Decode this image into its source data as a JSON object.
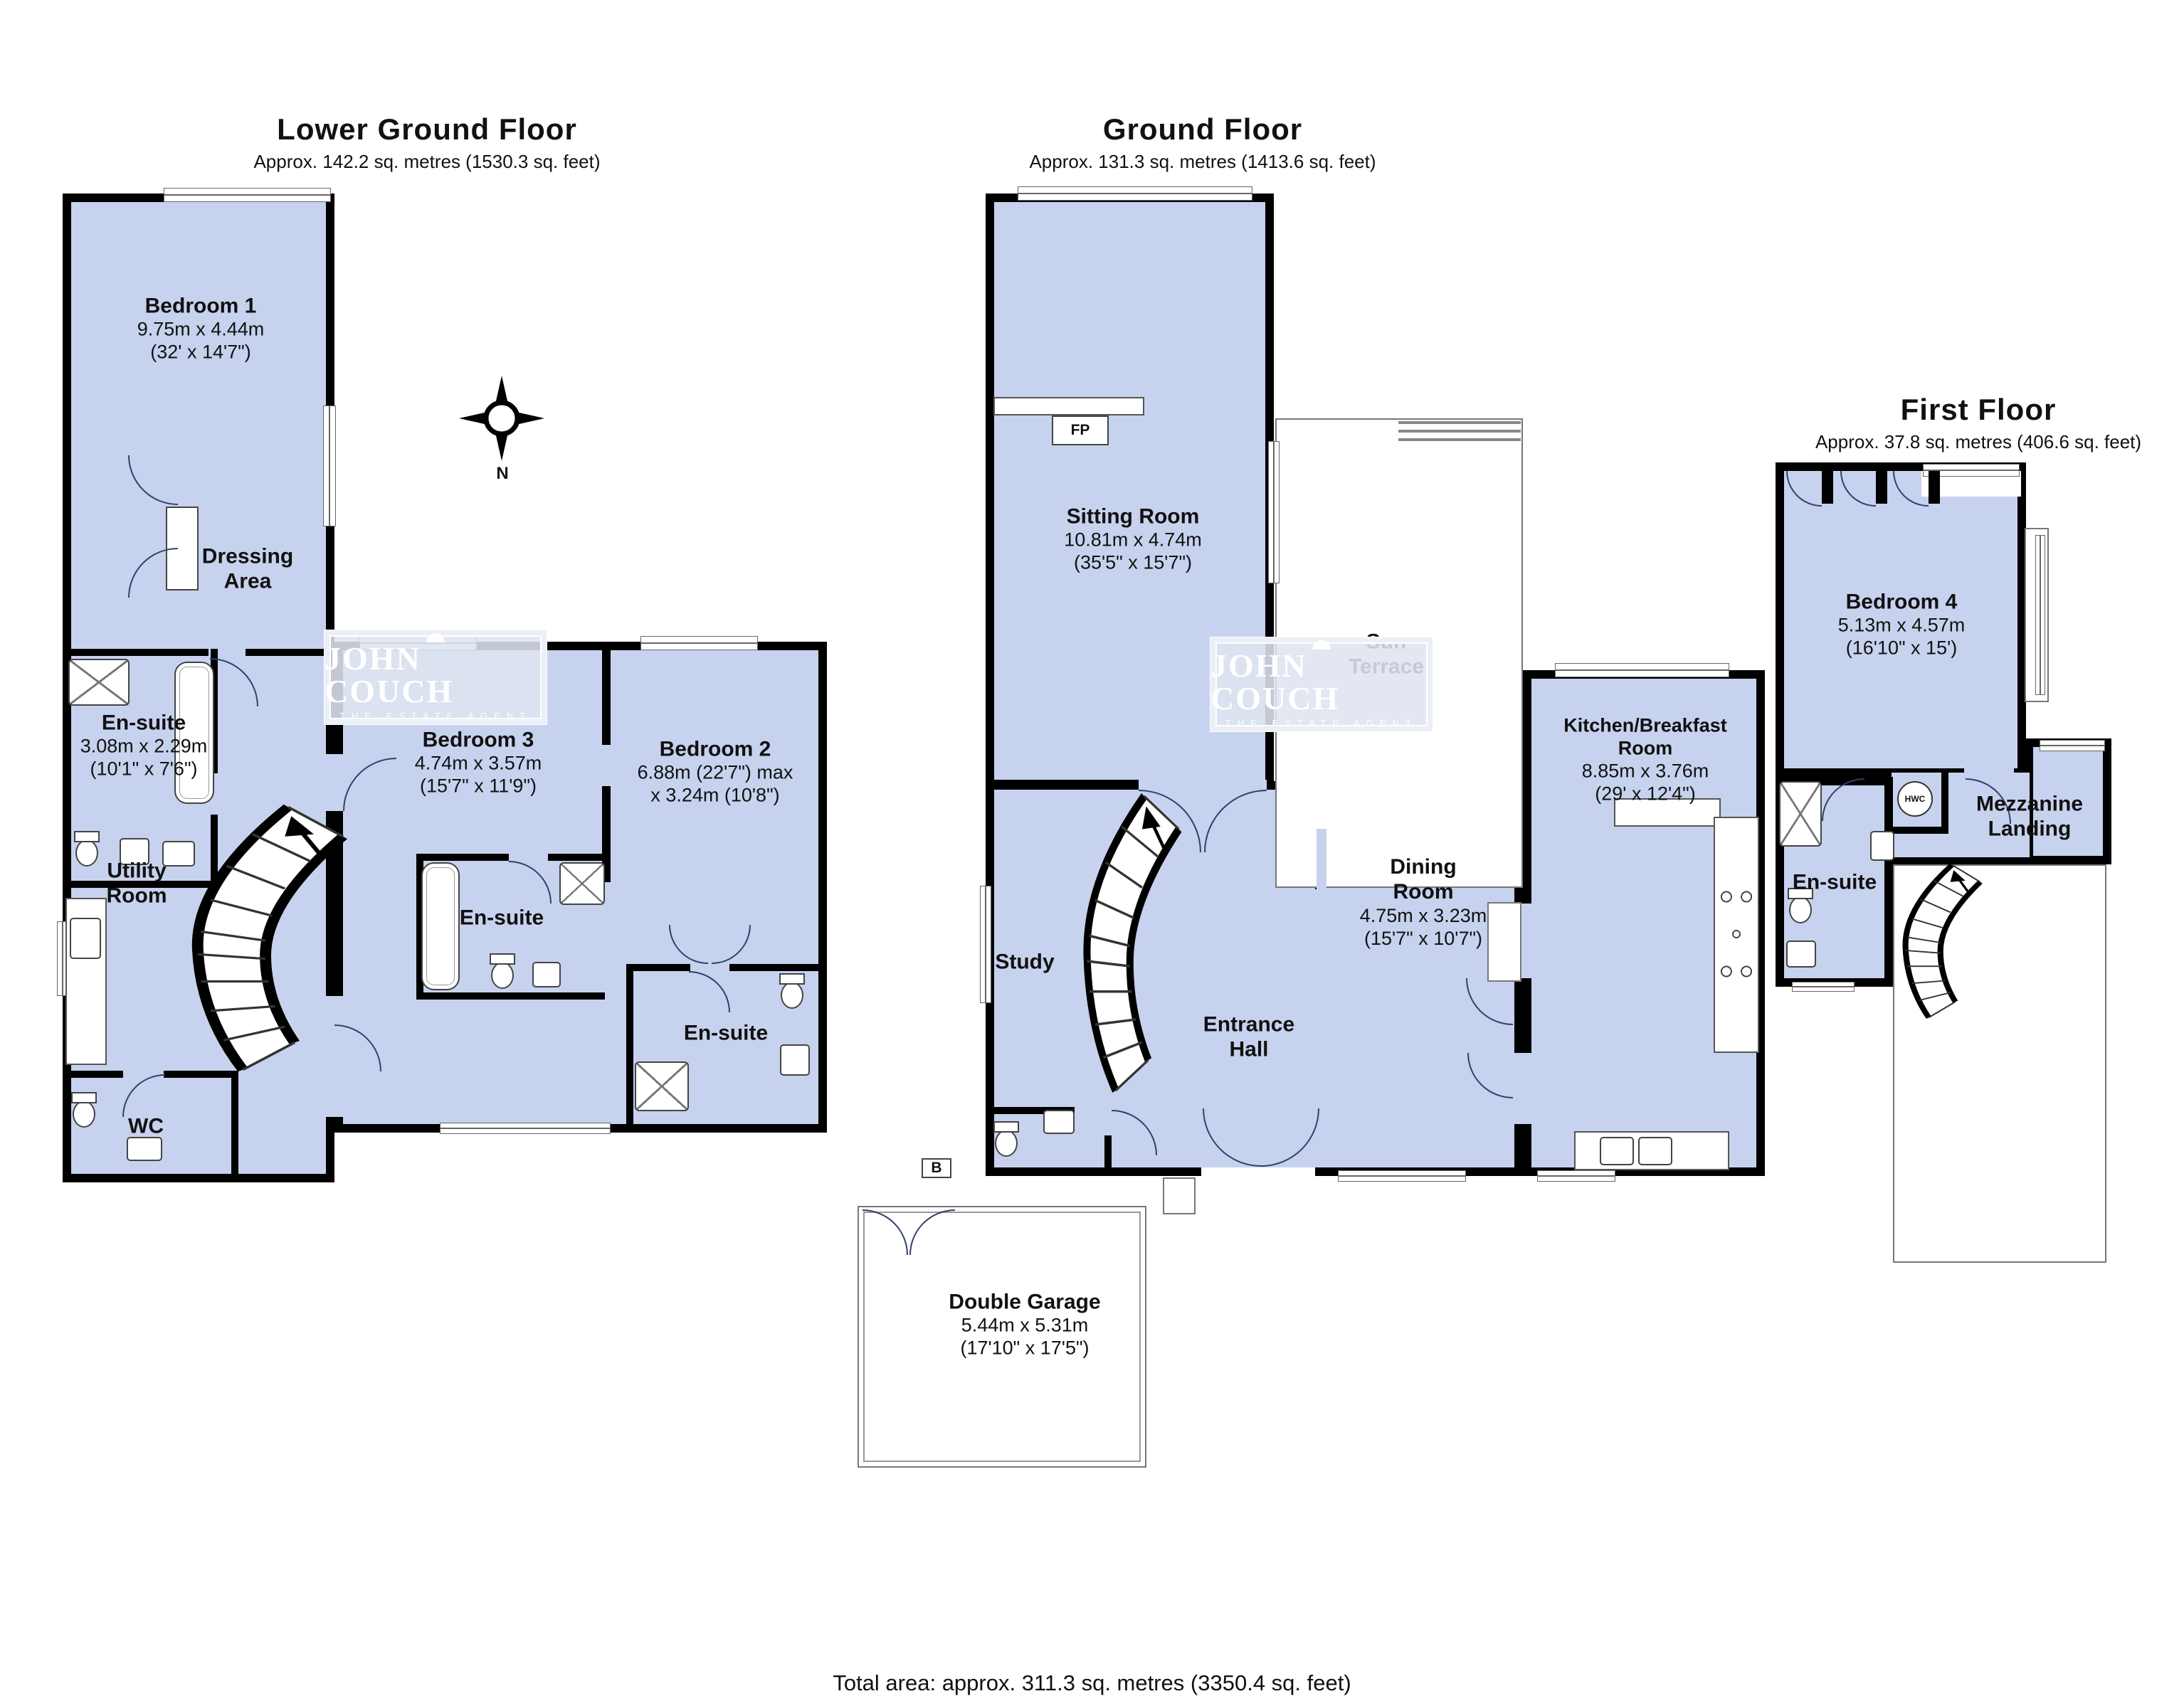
{
  "colors": {
    "room_fill": "#c7d2ee",
    "wall": "#000000",
    "door_arc": "#31406e",
    "window_frame": "#666666",
    "watermark_box": "#dee4f0"
  },
  "floors": {
    "lgf": {
      "title": "Lower Ground Floor",
      "area": "Approx. 142.2 sq. metres (1530.3 sq. feet)",
      "rooms": {
        "bedroom1": {
          "name": "Bedroom 1",
          "dims_m": "9.75m x 4.44m",
          "dims_i": "(32' x 14'7\")"
        },
        "dressing": {
          "name": "Dressing Area"
        },
        "ensuite1": {
          "name": "En-suite",
          "dims_m": "3.08m x 2.29m",
          "dims_i": "(10'1\" x 7'6\")"
        },
        "bedroom3": {
          "name": "Bedroom 3",
          "dims_m": "4.74m x 3.57m",
          "dims_i": "(15'7\" x 11'9\")"
        },
        "bedroom2": {
          "name": "Bedroom 2",
          "dims_m": "6.88m (22'7\") max",
          "dims_i": "x 3.24m (10'8\")"
        },
        "utility": {
          "name": "Utility Room"
        },
        "ensuite2": {
          "name": "En-suite"
        },
        "ensuite3": {
          "name": "En-suite"
        },
        "wc": {
          "name": "WC"
        }
      }
    },
    "gf": {
      "title": "Ground Floor",
      "area": "Approx. 131.3 sq. metres (1413.6 sq. feet)",
      "rooms": {
        "sitting": {
          "name": "Sitting Room",
          "dims_m": "10.81m x 4.74m",
          "dims_i": "(35'5\" x 15'7\")"
        },
        "terrace": {
          "name": "Sun Terrace"
        },
        "kitchen": {
          "name": "Kitchen/Breakfast Room",
          "dims_m": "8.85m x 3.76m",
          "dims_i": "(29' x 12'4\")"
        },
        "dining": {
          "name": "Dining Room",
          "dims_m": "4.75m x 3.23m",
          "dims_i": "(15'7\" x 10'7\")"
        },
        "study": {
          "name": "Study"
        },
        "entrance": {
          "name": "Entrance Hall"
        },
        "garage": {
          "name": "Double Garage",
          "dims_m": "5.44m x 5.31m",
          "dims_i": "(17'10\" x 17'5\")"
        }
      }
    },
    "ff": {
      "title": "First Floor",
      "area": "Approx. 37.8 sq. metres (406.6 sq. feet)",
      "rooms": {
        "bedroom4": {
          "name": "Bedroom 4",
          "dims_m": "5.13m x 4.57m",
          "dims_i": "(16'10\" x 15')"
        },
        "ensuite4": {
          "name": "En-suite"
        },
        "landing": {
          "name": "Mezzanine Landing"
        }
      }
    }
  },
  "markers": {
    "fireplace": "FP",
    "boiler": "B",
    "hot_water_cylinder": "HWC"
  },
  "compass": {
    "north_label": "N"
  },
  "branding": {
    "watermark_name": "JOHN COUCH",
    "watermark_tagline": "THE ESTATE AGENT"
  },
  "footer": {
    "total_area": "Total area: approx. 311.3 sq. metres (3350.4 sq. feet)"
  }
}
